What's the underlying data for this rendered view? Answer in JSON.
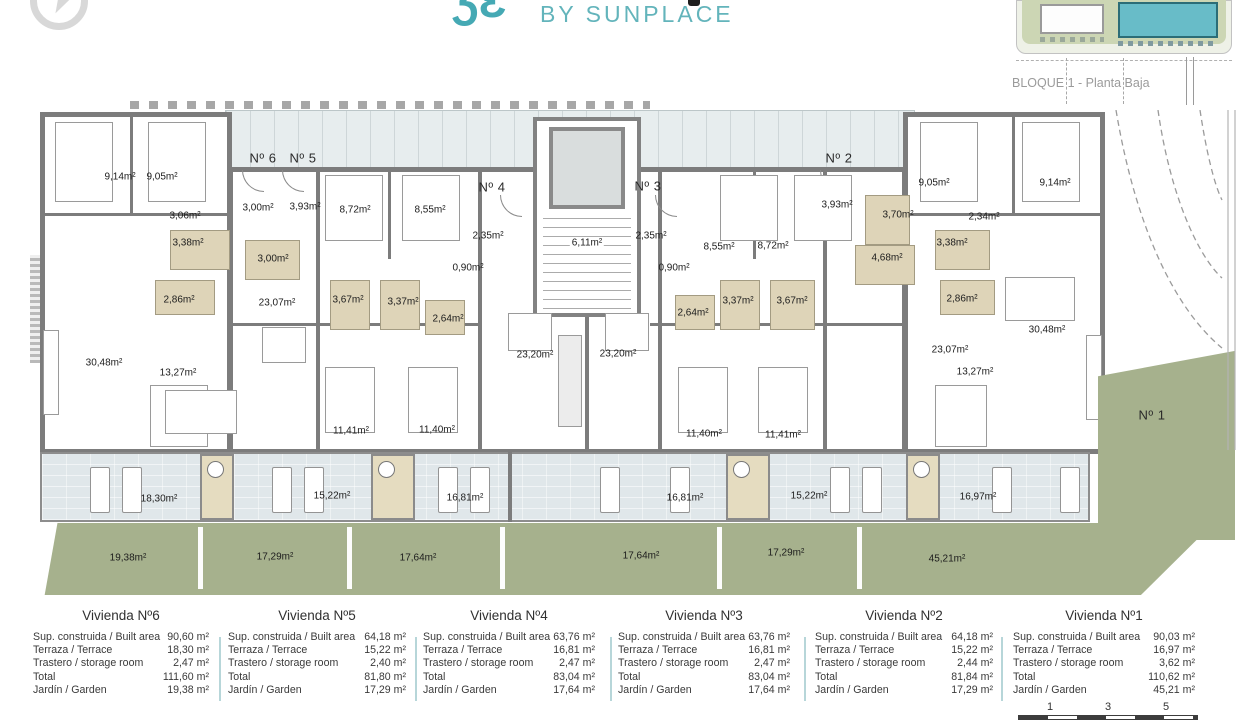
{
  "header": {
    "logo_mark_glyph": "ƷƐ",
    "brand_subtitle": "BY SUNPLACE",
    "key_plan_caption": "BLOQUE 1 - Planta Baja"
  },
  "colors": {
    "brand_teal": "#4FADB7",
    "key_plan_highlight": "#68BCC8",
    "wall_gray": "#7C7C7C",
    "terrace_floor": "#E0E7EA",
    "bathroom_floor": "#DED4B8",
    "garden_green": "#A6B18D",
    "table_divider_teal": "#B7D6D9"
  },
  "plan": {
    "unit_labels": [
      "Nº 6",
      "Nº 5",
      "Nº 4",
      "Nº 3",
      "Nº 2",
      "Nº 1"
    ],
    "room_labels": [
      "9,14m²",
      "9,05m²",
      "3,06m²",
      "3,00m²",
      "3,93m²",
      "8,72m²",
      "8,55m²",
      "3,38m²",
      "3,00m²",
      "2,86m²",
      "23,07m²",
      "3,67m²",
      "3,37m²",
      "2,64m²",
      "2,35m²",
      "0,90m²",
      "6,11m²",
      "2,35m²",
      "0,90m²",
      "8,55m²",
      "8,72m²",
      "3,37m²",
      "3,67m²",
      "2,64m²",
      "23,20m²",
      "23,20m²",
      "3,93m²",
      "3,70m²",
      "4,68m²",
      "3,38m²",
      "2,86m²",
      "2,34m²",
      "9,05m²",
      "9,14m²",
      "30,48m²",
      "13,27m²",
      "23,07m²",
      "13,27m²",
      "30,48m²",
      "11,41m²",
      "11,40m²",
      "11,40m²",
      "11,41m²"
    ],
    "terrace_labels": [
      "18,30m²",
      "15,22m²",
      "16,81m²",
      "16,81m²",
      "15,22m²",
      "16,97m²"
    ],
    "garden_labels": [
      "19,38m²",
      "17,29m²",
      "17,64m²",
      "17,64m²",
      "17,29m²",
      "45,21m²"
    ]
  },
  "table": {
    "row_labels": [
      "Sup. construida / Built area",
      "Terraza / Terrace",
      "Trastero / storage room",
      "Total",
      "Jardín / Garden"
    ],
    "columns": [
      {
        "title": "Vivienda Nº6",
        "values": [
          "90,60 m²",
          "18,30 m²",
          "2,47 m²",
          "111,60 m²",
          "19,38 m²"
        ]
      },
      {
        "title": "Vivienda Nº5",
        "values": [
          "64,18 m²",
          "15,22 m²",
          "2,40 m²",
          "81,80 m²",
          "17,29 m²"
        ]
      },
      {
        "title": "Vivienda Nº4",
        "values": [
          "63,76 m²",
          "16,81 m²",
          "2,47 m²",
          "83,04 m²",
          "17,64 m²"
        ]
      },
      {
        "title": "Vivienda Nº3",
        "values": [
          "63,76 m²",
          "16,81 m²",
          "2,47 m²",
          "83,04 m²",
          "17,64 m²"
        ]
      },
      {
        "title": "Vivienda Nº2",
        "values": [
          "64,18 m²",
          "15,22 m²",
          "2,44 m²",
          "81,84 m²",
          "17,29 m²"
        ]
      },
      {
        "title": "Vivienda Nº1",
        "values": [
          "90,03 m²",
          "16,97 m²",
          "3,62 m²",
          "110,62 m²",
          "45,21 m²"
        ]
      }
    ]
  },
  "scale_bar": {
    "ticks": [
      "1",
      "3",
      "5"
    ]
  }
}
